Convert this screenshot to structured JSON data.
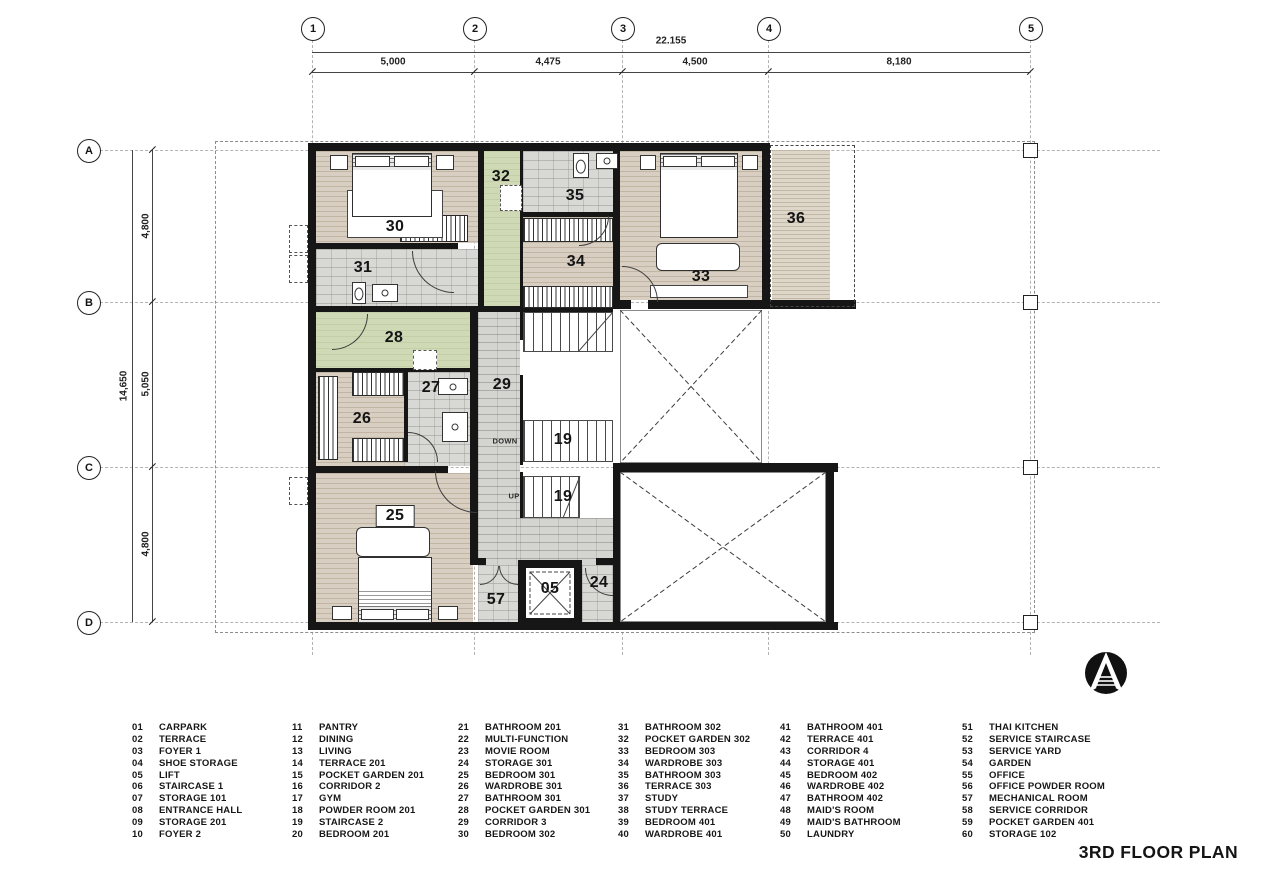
{
  "title": "3RD FLOOR PLAN",
  "grid": {
    "cols": [
      "1",
      "2",
      "3",
      "4",
      "5"
    ],
    "rows": [
      "A",
      "B",
      "C",
      "D"
    ]
  },
  "dims": {
    "overall_w": "22.155",
    "top": [
      "5,000",
      "4,475",
      "4,500",
      "8,180"
    ],
    "overall_h": "14,650",
    "left": [
      "4,800",
      "5,050",
      "4,800"
    ]
  },
  "rooms": [
    {
      "num": "30",
      "x": 395,
      "y": 227
    },
    {
      "num": "31",
      "x": 363,
      "y": 268
    },
    {
      "num": "32",
      "x": 501,
      "y": 177
    },
    {
      "num": "35",
      "x": 575,
      "y": 196
    },
    {
      "num": "34",
      "x": 576,
      "y": 262
    },
    {
      "num": "33",
      "x": 701,
      "y": 277
    },
    {
      "num": "36",
      "x": 796,
      "y": 219
    },
    {
      "num": "28",
      "x": 394,
      "y": 338
    },
    {
      "num": "27",
      "x": 431,
      "y": 388
    },
    {
      "num": "29",
      "x": 502,
      "y": 385
    },
    {
      "num": "26",
      "x": 362,
      "y": 419
    },
    {
      "num": "19",
      "x": 563,
      "y": 440
    },
    {
      "num": "19",
      "x": 563,
      "y": 497
    },
    {
      "num": "25",
      "x": 395,
      "y": 516,
      "boxed": true
    },
    {
      "num": "57",
      "x": 496,
      "y": 600
    },
    {
      "num": "05",
      "x": 550,
      "y": 589
    },
    {
      "num": "24",
      "x": 599,
      "y": 583
    }
  ],
  "notes": [
    {
      "text": "DOWN",
      "x": 505,
      "y": 441
    },
    {
      "text": "UP",
      "x": 514,
      "y": 496
    }
  ],
  "legend": [
    [
      {
        "n": "01",
        "t": "CARPARK"
      },
      {
        "n": "02",
        "t": "TERRACE"
      },
      {
        "n": "03",
        "t": "FOYER 1"
      },
      {
        "n": "04",
        "t": "SHOE STORAGE"
      },
      {
        "n": "05",
        "t": "LIFT"
      },
      {
        "n": "06",
        "t": "STAIRCASE 1"
      },
      {
        "n": "07",
        "t": "STORAGE 101"
      },
      {
        "n": "08",
        "t": "ENTRANCE HALL"
      },
      {
        "n": "09",
        "t": "STORAGE 201"
      },
      {
        "n": "10",
        "t": "FOYER 2"
      }
    ],
    [
      {
        "n": "11",
        "t": "PANTRY"
      },
      {
        "n": "12",
        "t": "DINING"
      },
      {
        "n": "13",
        "t": "LIVING"
      },
      {
        "n": "14",
        "t": "TERRACE 201"
      },
      {
        "n": "15",
        "t": "POCKET GARDEN 201"
      },
      {
        "n": "16",
        "t": "CORRIDOR 2"
      },
      {
        "n": "17",
        "t": "GYM"
      },
      {
        "n": "18",
        "t": "POWDER ROOM 201"
      },
      {
        "n": "19",
        "t": "STAIRCASE 2"
      },
      {
        "n": "20",
        "t": "BEDROOM 201"
      }
    ],
    [
      {
        "n": "21",
        "t": "BATHROOM 201"
      },
      {
        "n": "22",
        "t": "MULTI-FUNCTION"
      },
      {
        "n": "23",
        "t": "MOVIE ROOM"
      },
      {
        "n": "24",
        "t": "STORAGE 301"
      },
      {
        "n": "25",
        "t": "BEDROOM 301"
      },
      {
        "n": "26",
        "t": "WARDROBE 301"
      },
      {
        "n": "27",
        "t": "BATHROOM 301"
      },
      {
        "n": "28",
        "t": "POCKET GARDEN 301"
      },
      {
        "n": "29",
        "t": "CORRIDOR 3"
      },
      {
        "n": "30",
        "t": "BEDROOM 302"
      }
    ],
    [
      {
        "n": "31",
        "t": "BATHROOM 302"
      },
      {
        "n": "32",
        "t": "POCKET GARDEN 302"
      },
      {
        "n": "33",
        "t": "BEDROOM 303"
      },
      {
        "n": "34",
        "t": "WARDROBE 303"
      },
      {
        "n": "35",
        "t": "BATHROOM 303"
      },
      {
        "n": "36",
        "t": "TERRACE 303"
      },
      {
        "n": "37",
        "t": "STUDY"
      },
      {
        "n": "38",
        "t": "STUDY TERRACE"
      },
      {
        "n": "39",
        "t": "BEDROOM 401"
      },
      {
        "n": "40",
        "t": "WARDROBE 401"
      }
    ],
    [
      {
        "n": "41",
        "t": "BATHROOM 401"
      },
      {
        "n": "42",
        "t": "TERRACE 401"
      },
      {
        "n": "43",
        "t": "CORRIDOR 4"
      },
      {
        "n": "44",
        "t": "STORAGE 401"
      },
      {
        "n": "45",
        "t": "BEDROOM 402"
      },
      {
        "n": "46",
        "t": "WARDROBE 402"
      },
      {
        "n": "47",
        "t": "BATHROOM 402"
      },
      {
        "n": "48",
        "t": "MAID'S ROOM"
      },
      {
        "n": "49",
        "t": "MAID'S BATHROOM"
      },
      {
        "n": "50",
        "t": "LAUNDRY"
      }
    ],
    [
      {
        "n": "51",
        "t": "THAI KITCHEN"
      },
      {
        "n": "52",
        "t": "SERVICE STAIRCASE"
      },
      {
        "n": "53",
        "t": "SERVICE YARD"
      },
      {
        "n": "54",
        "t": "GARDEN"
      },
      {
        "n": "55",
        "t": "OFFICE"
      },
      {
        "n": "56",
        "t": "OFFICE POWDER ROOM"
      },
      {
        "n": "57",
        "t": "MECHANICAL ROOM"
      },
      {
        "n": "58",
        "t": "SERVICE CORRIDOR"
      },
      {
        "n": "59",
        "t": "POCKET GARDEN 401"
      },
      {
        "n": "60",
        "t": "STORAGE 102"
      }
    ]
  ]
}
